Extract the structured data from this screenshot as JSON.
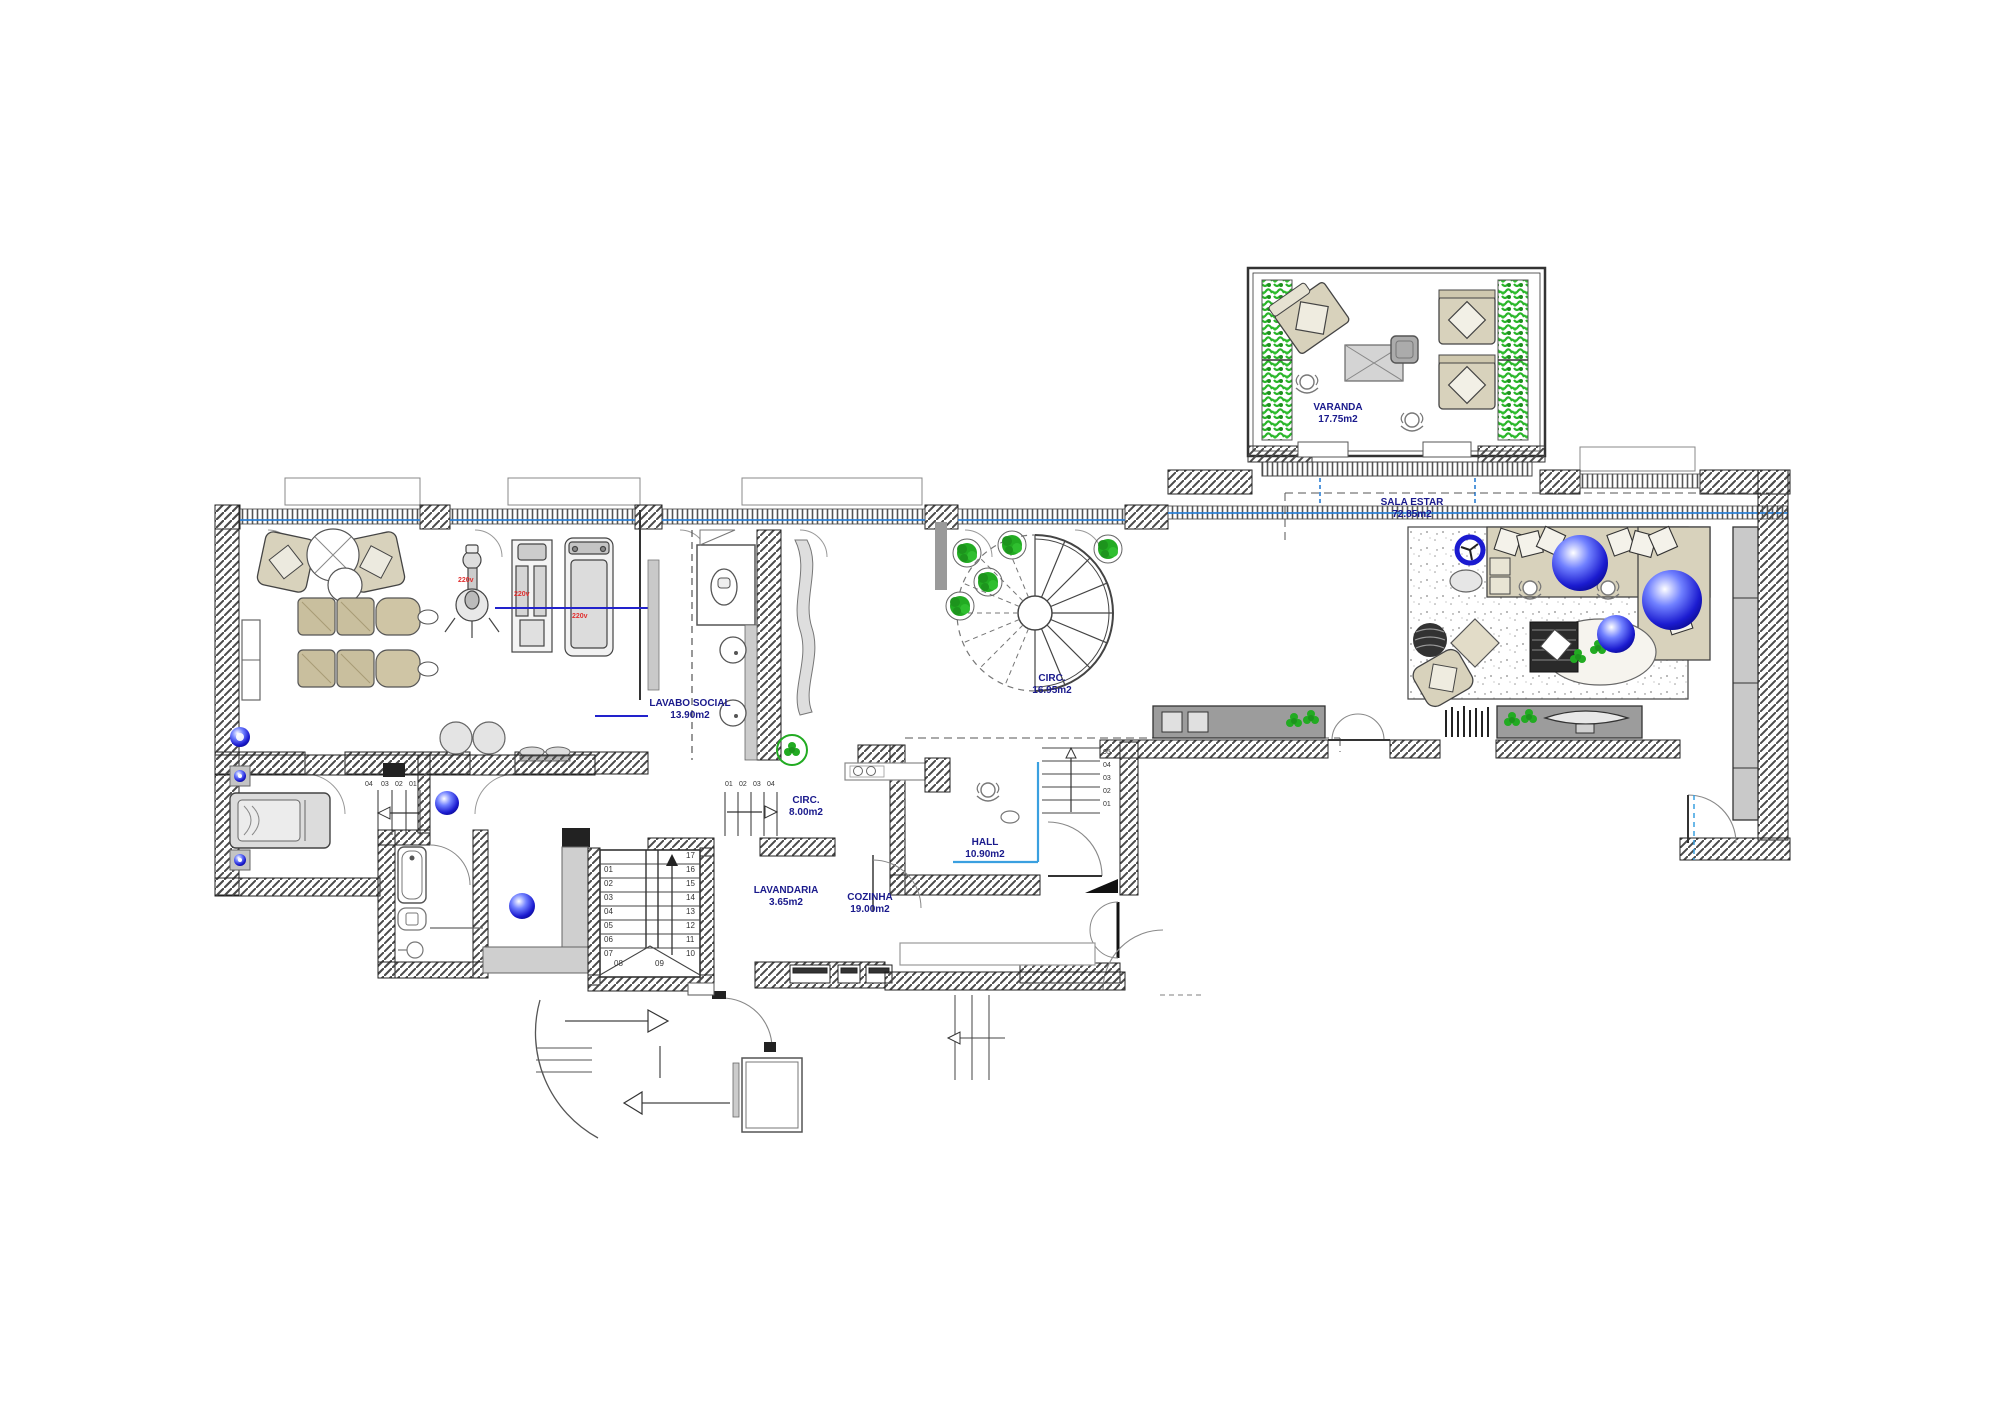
{
  "drawing": {
    "type": "residential floor plan",
    "language": "pt"
  },
  "rooms": {
    "varanda": {
      "name": "VARANDA",
      "area": "17.75m2"
    },
    "sala_estar": {
      "name": "SALA ESTAR",
      "area": "72.85m2"
    },
    "lavabo_social": {
      "name": "LAVABO SOCIAL",
      "area": "13.90m2"
    },
    "circ_stair": {
      "name": "CIRC.",
      "area": "16.95m2"
    },
    "circ_corridor": {
      "name": "CIRC.",
      "area": "8.00m2"
    },
    "hall": {
      "name": "HALL",
      "area": "10.90m2"
    },
    "lavandaria": {
      "name": "LAVANDARIA",
      "area": "3.65m2"
    },
    "cozinha": {
      "name": "COZINHA",
      "area": "19.00m2"
    }
  },
  "stairs": {
    "main": {
      "left": [
        "01",
        "02",
        "03",
        "04",
        "05",
        "06",
        "07"
      ],
      "right": [
        "17",
        "16",
        "15",
        "14",
        "13",
        "12",
        "11",
        "10"
      ],
      "bottom": [
        "08",
        "09"
      ]
    },
    "hall": [
      "05",
      "04",
      "03",
      "02",
      "01"
    ],
    "bedroom": [
      "04",
      "03",
      "02",
      "01"
    ],
    "corridor": [
      "01",
      "02",
      "03",
      "04"
    ]
  },
  "annotations": {
    "power1": "220v",
    "power2": "220v",
    "power3": "220v"
  },
  "colors": {
    "label": "#1a1a8c",
    "glass": "#2b7fd4",
    "cyan": "#3aa0e0",
    "wall": "#3c3c3c",
    "plant": "#22ab22",
    "sphere": "#2233dd",
    "beige": "#d8d2bc",
    "red": "#e03030"
  }
}
